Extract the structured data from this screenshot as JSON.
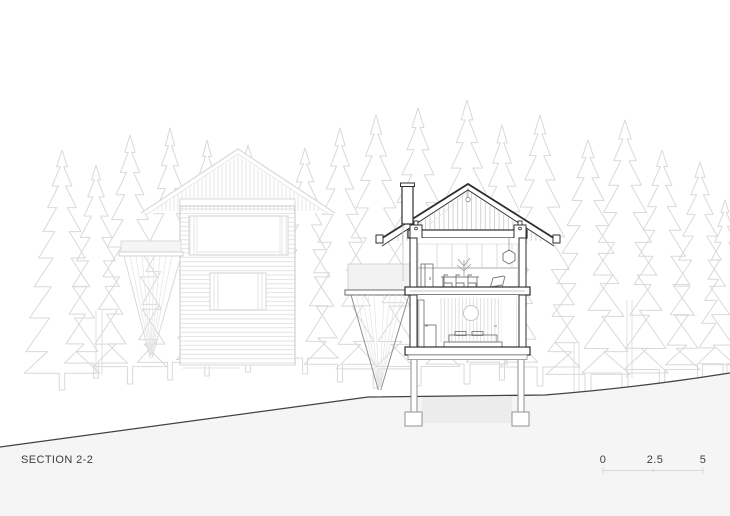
{
  "drawing": {
    "title": "SECTION 2-2",
    "scale_bar": {
      "labels": [
        "0",
        "2.5",
        "5"
      ]
    },
    "palette": {
      "paper": "#ffffff",
      "cut_line": "#2e2e2e",
      "background_line": "#d9d9d9",
      "ground_fill": "#f5f5f5",
      "ground_line": "#424242",
      "text": "#3d3d3d"
    }
  }
}
